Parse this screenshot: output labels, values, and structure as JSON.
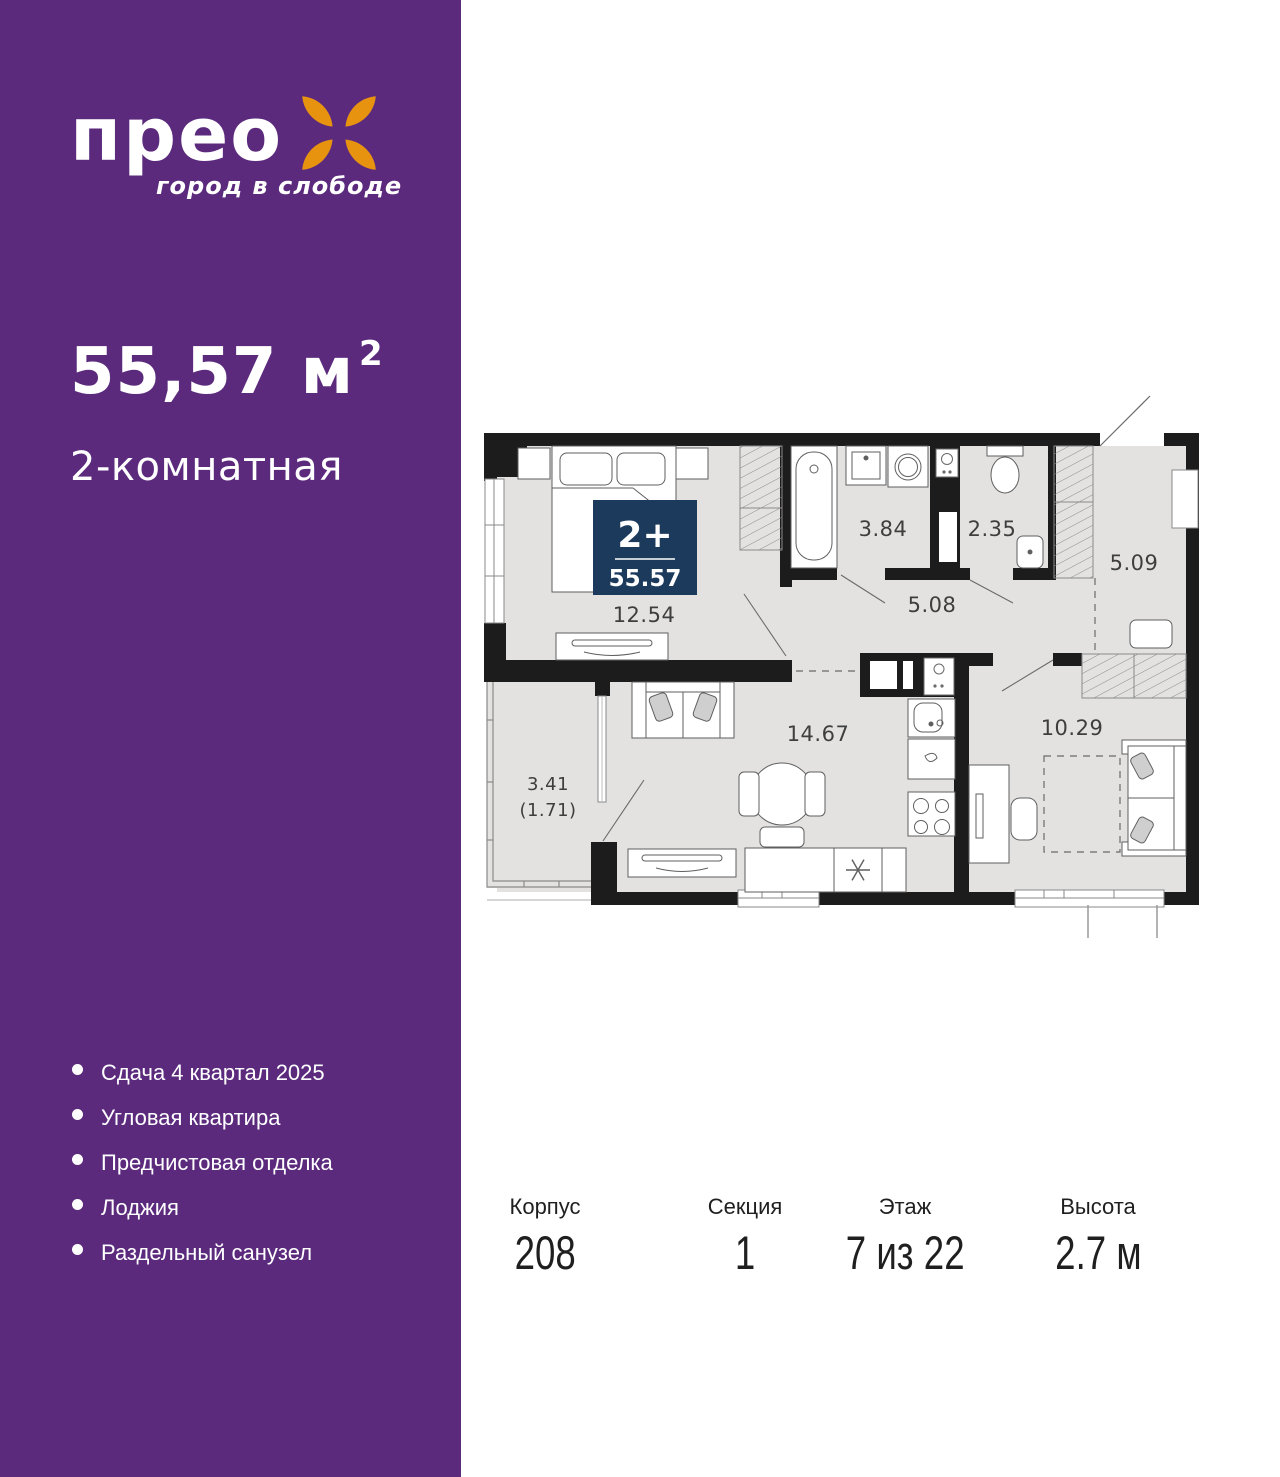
{
  "brand": {
    "logo": "прео",
    "tagline": "город в слободе"
  },
  "listing": {
    "area_text": "55,57 м",
    "area_sup": "2",
    "type": "2-комнатная"
  },
  "features": [
    "Сдача 4 квартал 2025",
    "Угловая квартира",
    "Предчистовая отделка",
    "Лоджия",
    "Раздельный санузел"
  ],
  "plan": {
    "badge": {
      "rooms": "2+",
      "area": "55.57"
    },
    "labels": {
      "bedroom": "12.54",
      "bathroom": "3.84",
      "wc": "2.35",
      "hallway": "5.09",
      "corridor": "5.08",
      "living": "14.67",
      "room2": "10.29",
      "loggia": "3.41",
      "loggia_reduced": "(1.71)"
    }
  },
  "summary": [
    {
      "label": "Корпус",
      "value": "208"
    },
    {
      "label": "Секция",
      "value": "1"
    },
    {
      "label": "Этаж",
      "value": "7 из 22"
    },
    {
      "label": "Высота",
      "value": "2.7 м"
    }
  ],
  "colors": {
    "sidebar_purple": "#5B2A7D",
    "accent_orange": "#E8930F",
    "badge_navy": "#1C3A5C",
    "floor_gray": "#E3E2E1",
    "wall_black": "#1C1C1C"
  }
}
